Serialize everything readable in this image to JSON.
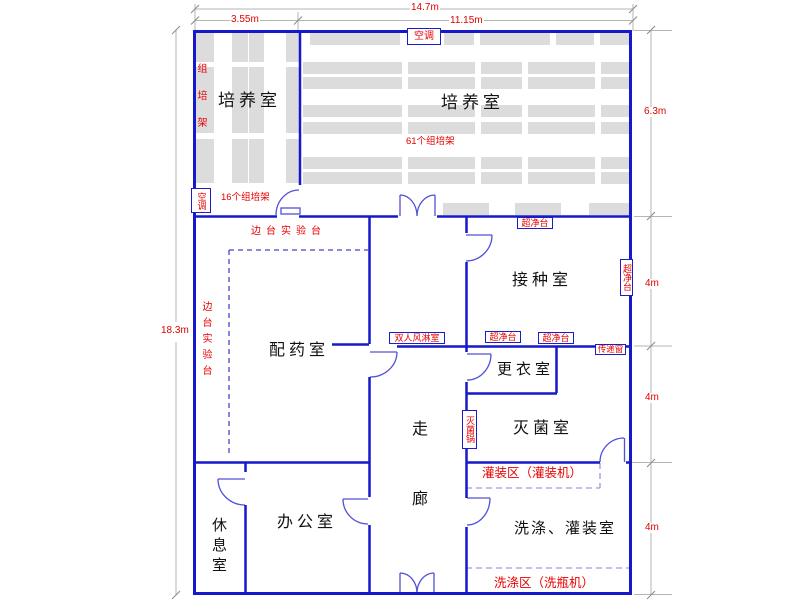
{
  "drawing": {
    "type": "tissue-culture-lab-floor-plan"
  },
  "rooms": {
    "culture_left": "培养室",
    "culture_right": "培养室",
    "inoculation": "接种室",
    "preparation": "配药室",
    "changing": "更衣室",
    "sterilization": "灭菌室",
    "corridor": "走廊",
    "office": "办公室",
    "rest": "休息室",
    "wash_fill": "洗涤、灌装室"
  },
  "equipment": {
    "aircon_top": "空调",
    "aircon_left": "空调",
    "rack_left": "组培架",
    "racks_16": "16个组培架",
    "racks_61": "61个组培架",
    "bench_top": "边台实验台",
    "bench_left": "边台实验台",
    "clean_bench_top": "超净台",
    "clean_bench_right": "超净台",
    "clean_bench_bottom1": "超净台",
    "clean_bench_bottom2": "超净台",
    "air_shower": "双人风淋室",
    "pass_window": "传递窗",
    "sterilizer": "灭菌锅",
    "filling_zone": "灌装区（灌装机）",
    "washing_zone": "洗涤区（洗瓶机）"
  },
  "dimensions": {
    "top_total": "14.7m",
    "top_left": "3.55m",
    "top_right": "11.15m",
    "left_total": "18.3m",
    "right": [
      "6.3m",
      "4m",
      "4m",
      "4m"
    ]
  },
  "colors": {
    "wall": "#1518cb",
    "red_label": "#e80000",
    "shelf": "#dcdcdc",
    "dim_line": "#aaaaaa"
  }
}
